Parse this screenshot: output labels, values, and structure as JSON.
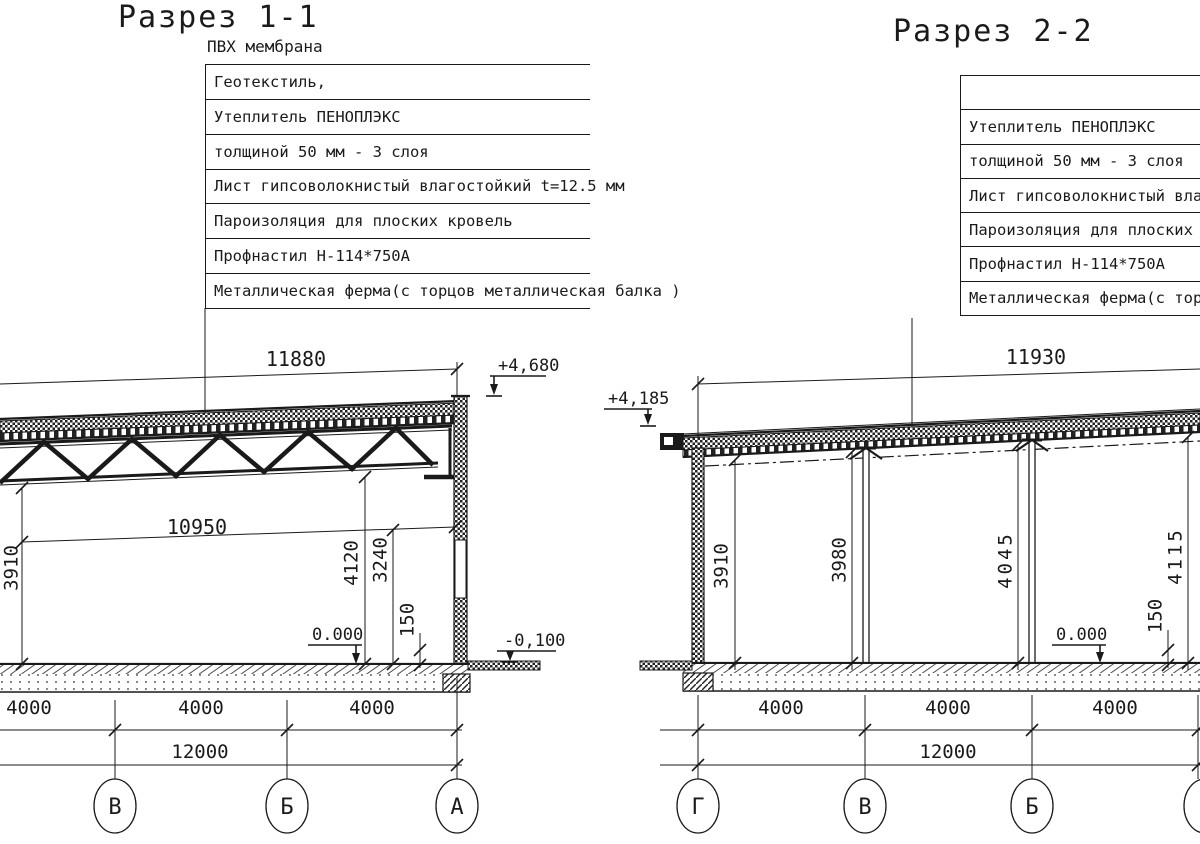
{
  "drawing": {
    "left": {
      "title": "Разрез 1-1",
      "top_label": "ПВХ мембрана",
      "layers": [
        "Геотекстиль,",
        "Утеплитель ПЕНОПЛЭКС",
        "толщиной 50 мм - 3 слоя",
        "Лист гипсоволокнистый влагостойкий t=12.5 мм",
        "Пароизоляция для плоских кровель",
        "Профнастил Н-114*750А",
        "Металлическая ферма(с торцов металлическая балка )"
      ],
      "dims": {
        "roof_span": "11880",
        "clear_span": "10950",
        "h_left": "3910",
        "h_mid": "4120",
        "h_mid2": "3240",
        "plinth": "150",
        "elev_top": "+4,680",
        "elev_zero": "0.000",
        "elev_ground": "-0,100",
        "bays": [
          "4000",
          "4000",
          "4000"
        ],
        "total": "12000"
      },
      "axes": [
        "В",
        "Б",
        "А"
      ]
    },
    "right": {
      "title": "Разрез 2-2",
      "layers": [
        "",
        "Утеплитель ПЕНОПЛЭКС",
        "толщиной 50 мм - 3 слоя",
        "Лист гипсоволокнистый влагостой",
        "Пароизоляция для плоских кровел",
        "Профнастил Н-114*750А",
        "Металлическая ферма(с торцов м"
      ],
      "dims": {
        "roof_span": "11930",
        "heights": [
          "3910",
          "3980",
          "4045",
          "4115"
        ],
        "plinth": "150",
        "elev_top": "+4,185",
        "elev_zero": "0.000",
        "bays": [
          "4000",
          "4000",
          "4000"
        ],
        "total": "12000"
      },
      "axes": [
        "Г",
        "В",
        "Б"
      ]
    },
    "line_color": "#1a1a1a"
  }
}
